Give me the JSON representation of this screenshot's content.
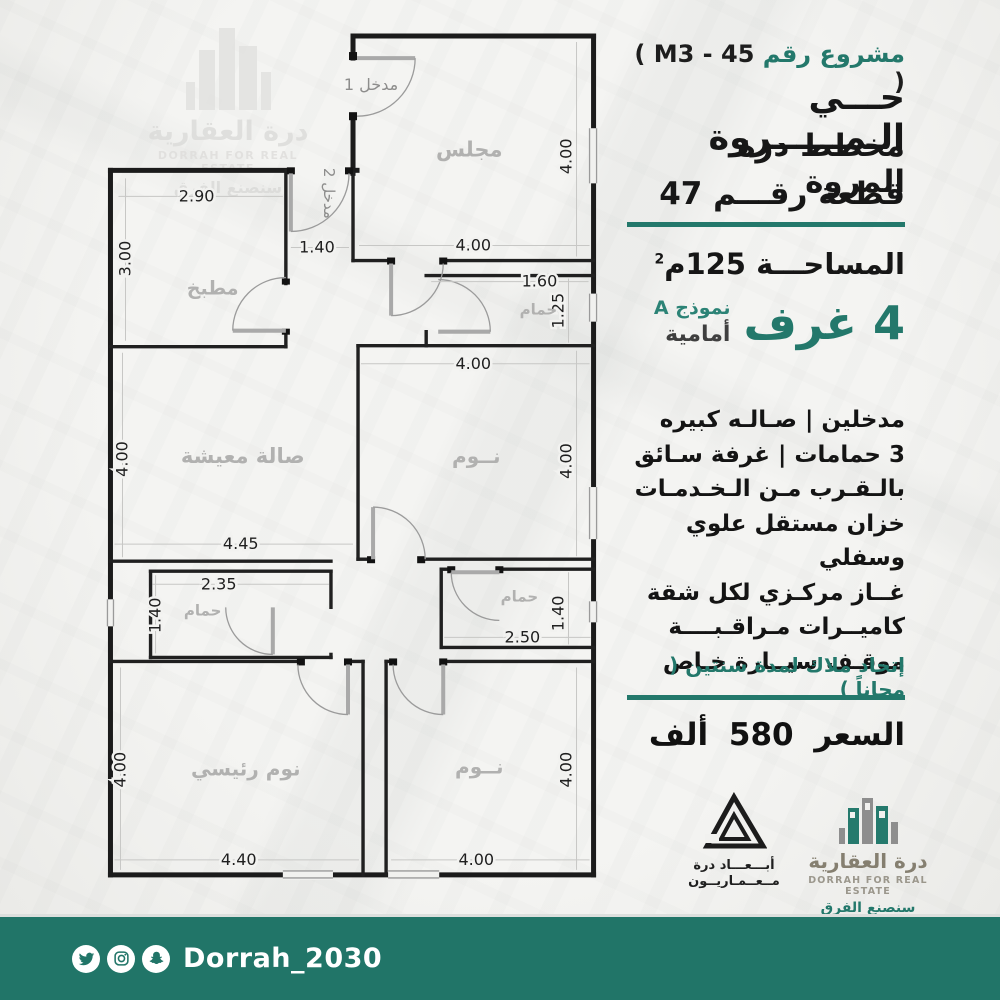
{
  "colors": {
    "teal": "#23786b",
    "bar": "#217568"
  },
  "watermark_logo": {
    "name_ar": "درة العقارية",
    "name_en": "DORRAH FOR REAL ESTATE",
    "tagline": "سنصنع الفرق"
  },
  "right_panel": {
    "project_label": "مشروع رقم",
    "project_code": "( M3 - 45 )",
    "district": "حـــي الـمــــــروة",
    "plan_name": "مخطط درة المروة",
    "plot": "قطعة رقـــم 47",
    "area_label": "المساحـــة 125م",
    "area_sup": "2",
    "rooms_big": "4 غرف",
    "model": "نموذج A",
    "model_side": "أمامية",
    "features": [
      "مدخلين | صـالـه كبيره",
      "3 حمامات | غرفة سـائق",
      "بالـقـرب مـن الـخـدمـات",
      "خزان مستقل علوي وسفلي",
      "غــاز مركـزي لكل شقة",
      "كاميــرات مـراقـبــــة",
      "موقـف سيــارة خـاص"
    ],
    "owners_union": "إتحاد ملاك لمدة سنتين ( مجاناً )",
    "price": "السعر 580 ألف"
  },
  "footer": {
    "abaad_line1": "أبـــعـــاد درة",
    "abaad_line2": "مــعــمـاريــون",
    "dorrah_ar": "درة العقارية",
    "dorrah_en": "DORRAH FOR REAL ESTATE",
    "dorrah_tagline": "سنصنع الفرق"
  },
  "social": {
    "handle": "Dorrah_2030",
    "icons": [
      "twitter-icon",
      "instagram-icon",
      "snapchat-icon"
    ]
  },
  "floor_plan": {
    "unit": "m",
    "entrances": [
      "مدخل 1",
      "مدخل 2"
    ],
    "labels": [
      {
        "t": "مجلس",
        "x": 378,
        "y": 128,
        "s": 21,
        "c": "room"
      },
      {
        "t": "مطبخ",
        "x": 122,
        "y": 266,
        "s": 19,
        "c": "room"
      },
      {
        "t": "حمام",
        "x": 447,
        "y": 286,
        "s": 15,
        "c": "room"
      },
      {
        "t": "صالة معيشة",
        "x": 152,
        "y": 434,
        "s": 21,
        "c": "room"
      },
      {
        "t": "نــوم",
        "x": 385,
        "y": 434,
        "s": 20,
        "c": "room"
      },
      {
        "t": "حمام",
        "x": 112,
        "y": 586,
        "s": 15,
        "c": "room"
      },
      {
        "t": "حمام",
        "x": 428,
        "y": 572,
        "s": 15,
        "c": "room"
      },
      {
        "t": "نوم رئيسي",
        "x": 155,
        "y": 746,
        "s": 20,
        "c": "room"
      },
      {
        "t": "نــوم",
        "x": 388,
        "y": 744,
        "s": 20,
        "c": "room"
      },
      {
        "t": "مدخل 1",
        "x": 280,
        "y": 62,
        "s": 16,
        "c": "ent",
        "r": 0
      },
      {
        "t": "مدخل 2",
        "x": 233,
        "y": 165,
        "s": 15,
        "c": "ent",
        "r": 90
      }
    ],
    "dims": [
      {
        "t": "2.90",
        "x": 106,
        "y": 173
      },
      {
        "t": "3.00",
        "x": 40,
        "y": 230,
        "r": -90
      },
      {
        "t": "1.40",
        "x": 226,
        "y": 224
      },
      {
        "t": "4.00",
        "x": 382,
        "y": 222
      },
      {
        "t": "4.00",
        "x": 480,
        "y": 128,
        "r": -90
      },
      {
        "t": "1.60",
        "x": 448,
        "y": 258
      },
      {
        "t": "1.25",
        "x": 472,
        "y": 282,
        "r": -90
      },
      {
        "t": "4.00",
        "x": 382,
        "y": 340
      },
      {
        "t": "4.00",
        "x": 480,
        "y": 432,
        "r": -90
      },
      {
        "t": "4.00",
        "x": 37,
        "y": 430,
        "r": -90
      },
      {
        "t": "4.45",
        "x": 150,
        "y": 520
      },
      {
        "t": "2.35",
        "x": 128,
        "y": 560
      },
      {
        "t": "1.40",
        "x": 70,
        "y": 586,
        "r": -90
      },
      {
        "t": "2.50",
        "x": 431,
        "y": 613
      },
      {
        "t": "1.40",
        "x": 472,
        "y": 584,
        "r": -90
      },
      {
        "t": "4.00",
        "x": 35,
        "y": 740,
        "r": -90
      },
      {
        "t": "4.40",
        "x": 148,
        "y": 835
      },
      {
        "t": "4.00",
        "x": 480,
        "y": 740,
        "r": -90
      },
      {
        "t": "4.00",
        "x": 385,
        "y": 835
      }
    ]
  }
}
